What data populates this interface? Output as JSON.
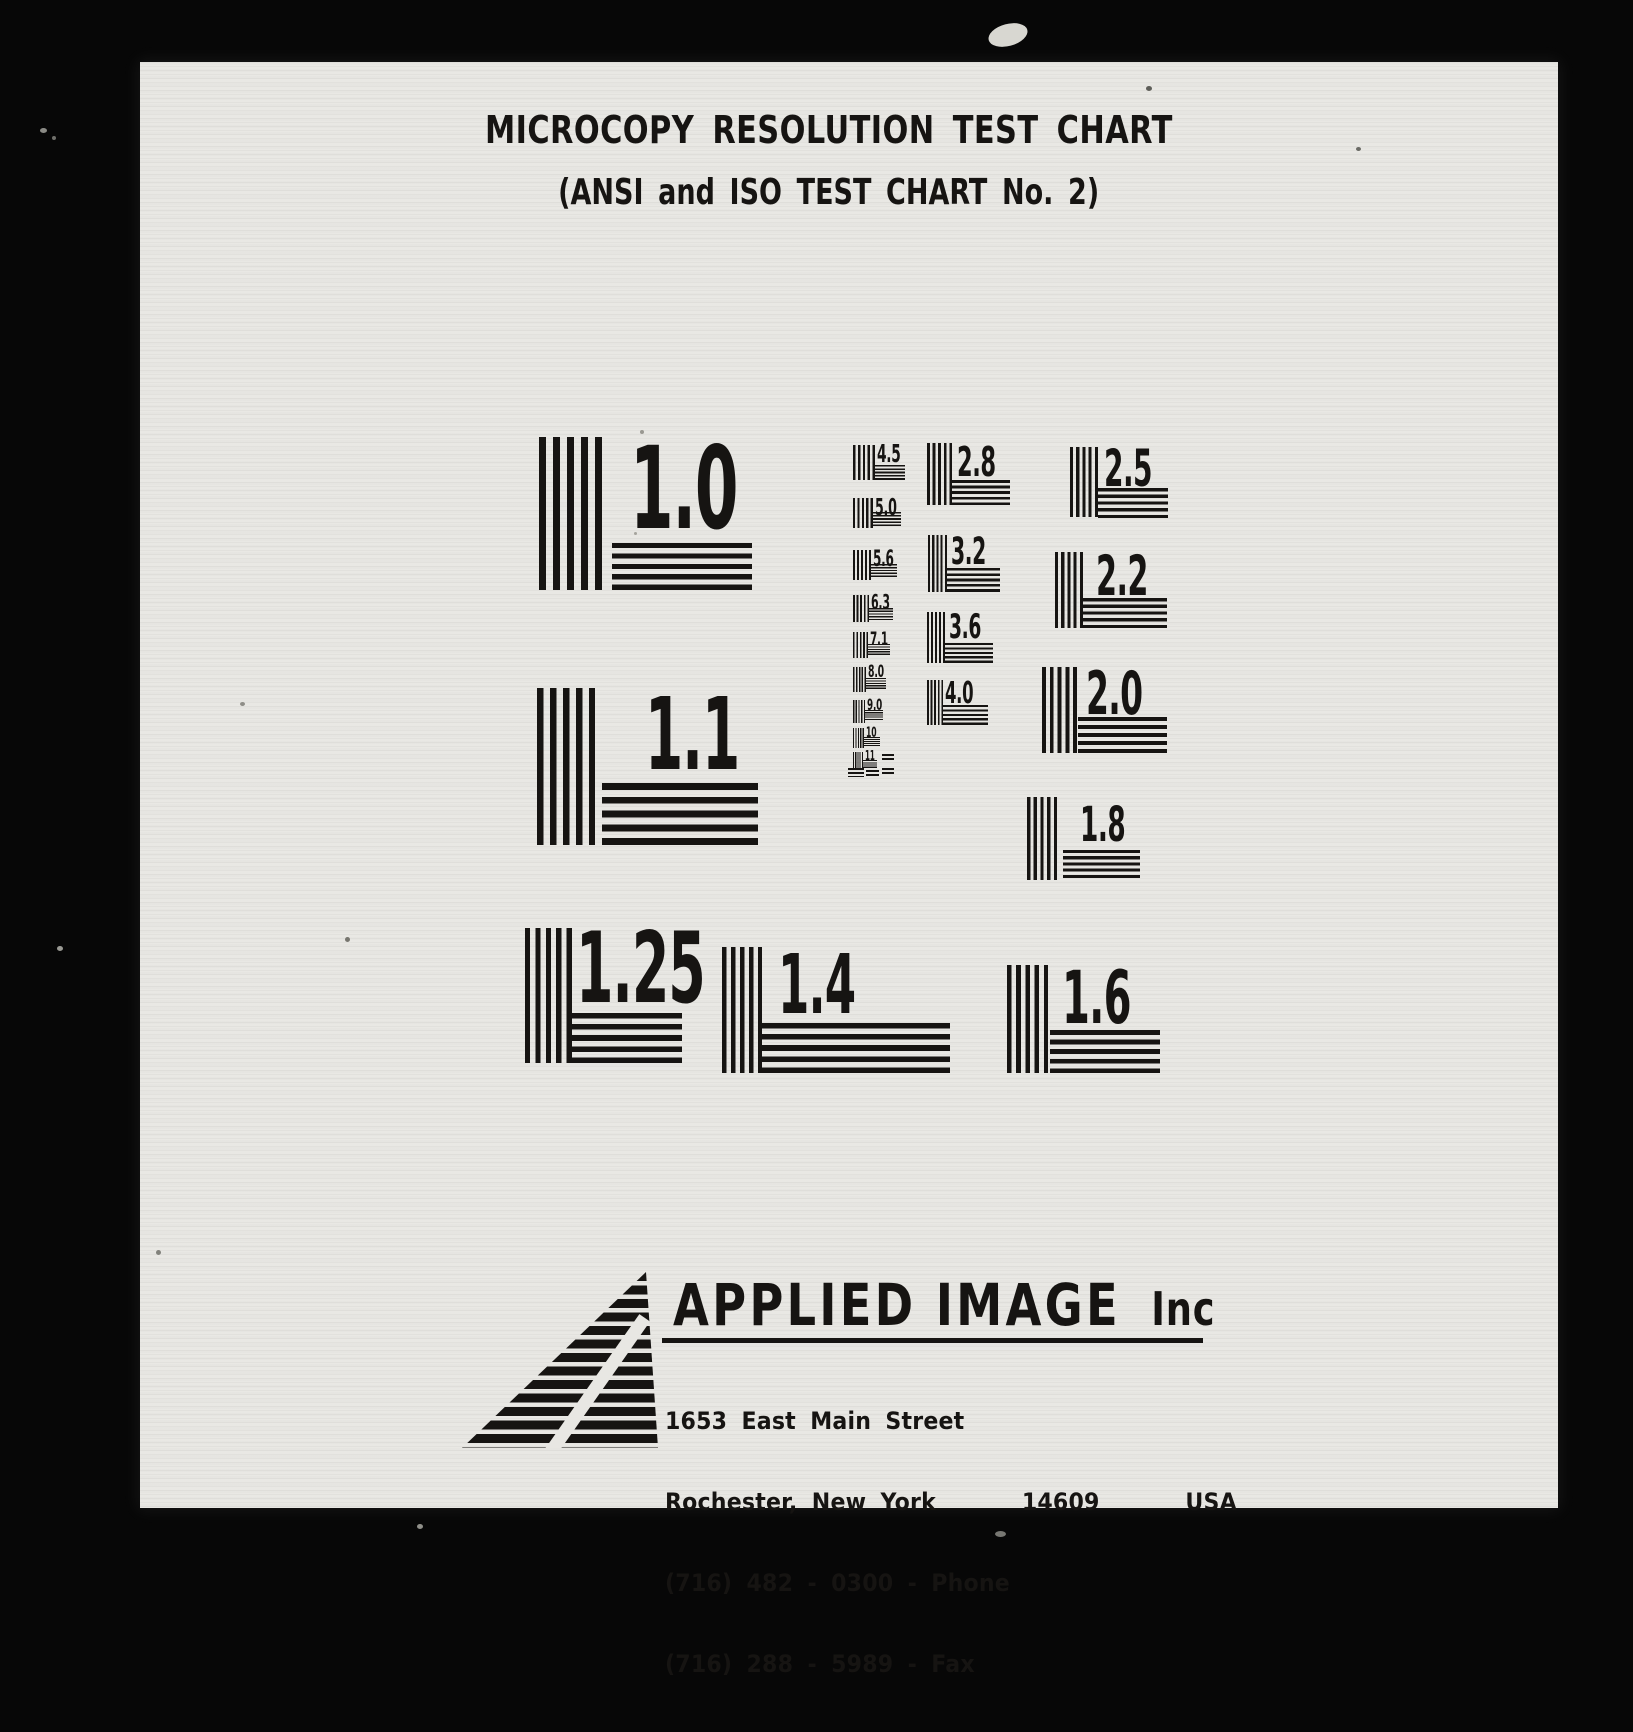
{
  "colors": {
    "bg": "#070707",
    "paper": "#e8e7e3",
    "ink": "#161412"
  },
  "header": {
    "title": "MICROCOPY RESOLUTION TEST CHART",
    "subtitle": "(ANSI and ISO TEST CHART No. 2)"
  },
  "targets": {
    "large": [
      {
        "label": "1.0"
      },
      {
        "label": "1.1"
      },
      {
        "label": "1.25"
      },
      {
        "label": "1.4"
      },
      {
        "label": "1.6"
      },
      {
        "label": "2.8"
      },
      {
        "label": "3.2"
      },
      {
        "label": "3.6"
      },
      {
        "label": "4.0"
      },
      {
        "label": "2.5"
      },
      {
        "label": "2.2"
      },
      {
        "label": "2.0"
      },
      {
        "label": "1.8"
      }
    ],
    "small": [
      {
        "label": "4.5"
      },
      {
        "label": "5.0"
      },
      {
        "label": "5.6"
      },
      {
        "label": "6.3"
      },
      {
        "label": "7.1"
      },
      {
        "label": "8.0"
      },
      {
        "label": "9.0"
      },
      {
        "label": "10"
      },
      {
        "label": "11"
      }
    ]
  },
  "footer": {
    "company": "APPLIED IMAGE",
    "company_suffix": "Inc",
    "address_line1": "1653 East Main Street",
    "address_line2": "Rochester, New York      14609      USA",
    "phone_line": "(716) 482 - 0300 - Phone",
    "fax_line": "(716) 288 - 5989 - Fax"
  }
}
